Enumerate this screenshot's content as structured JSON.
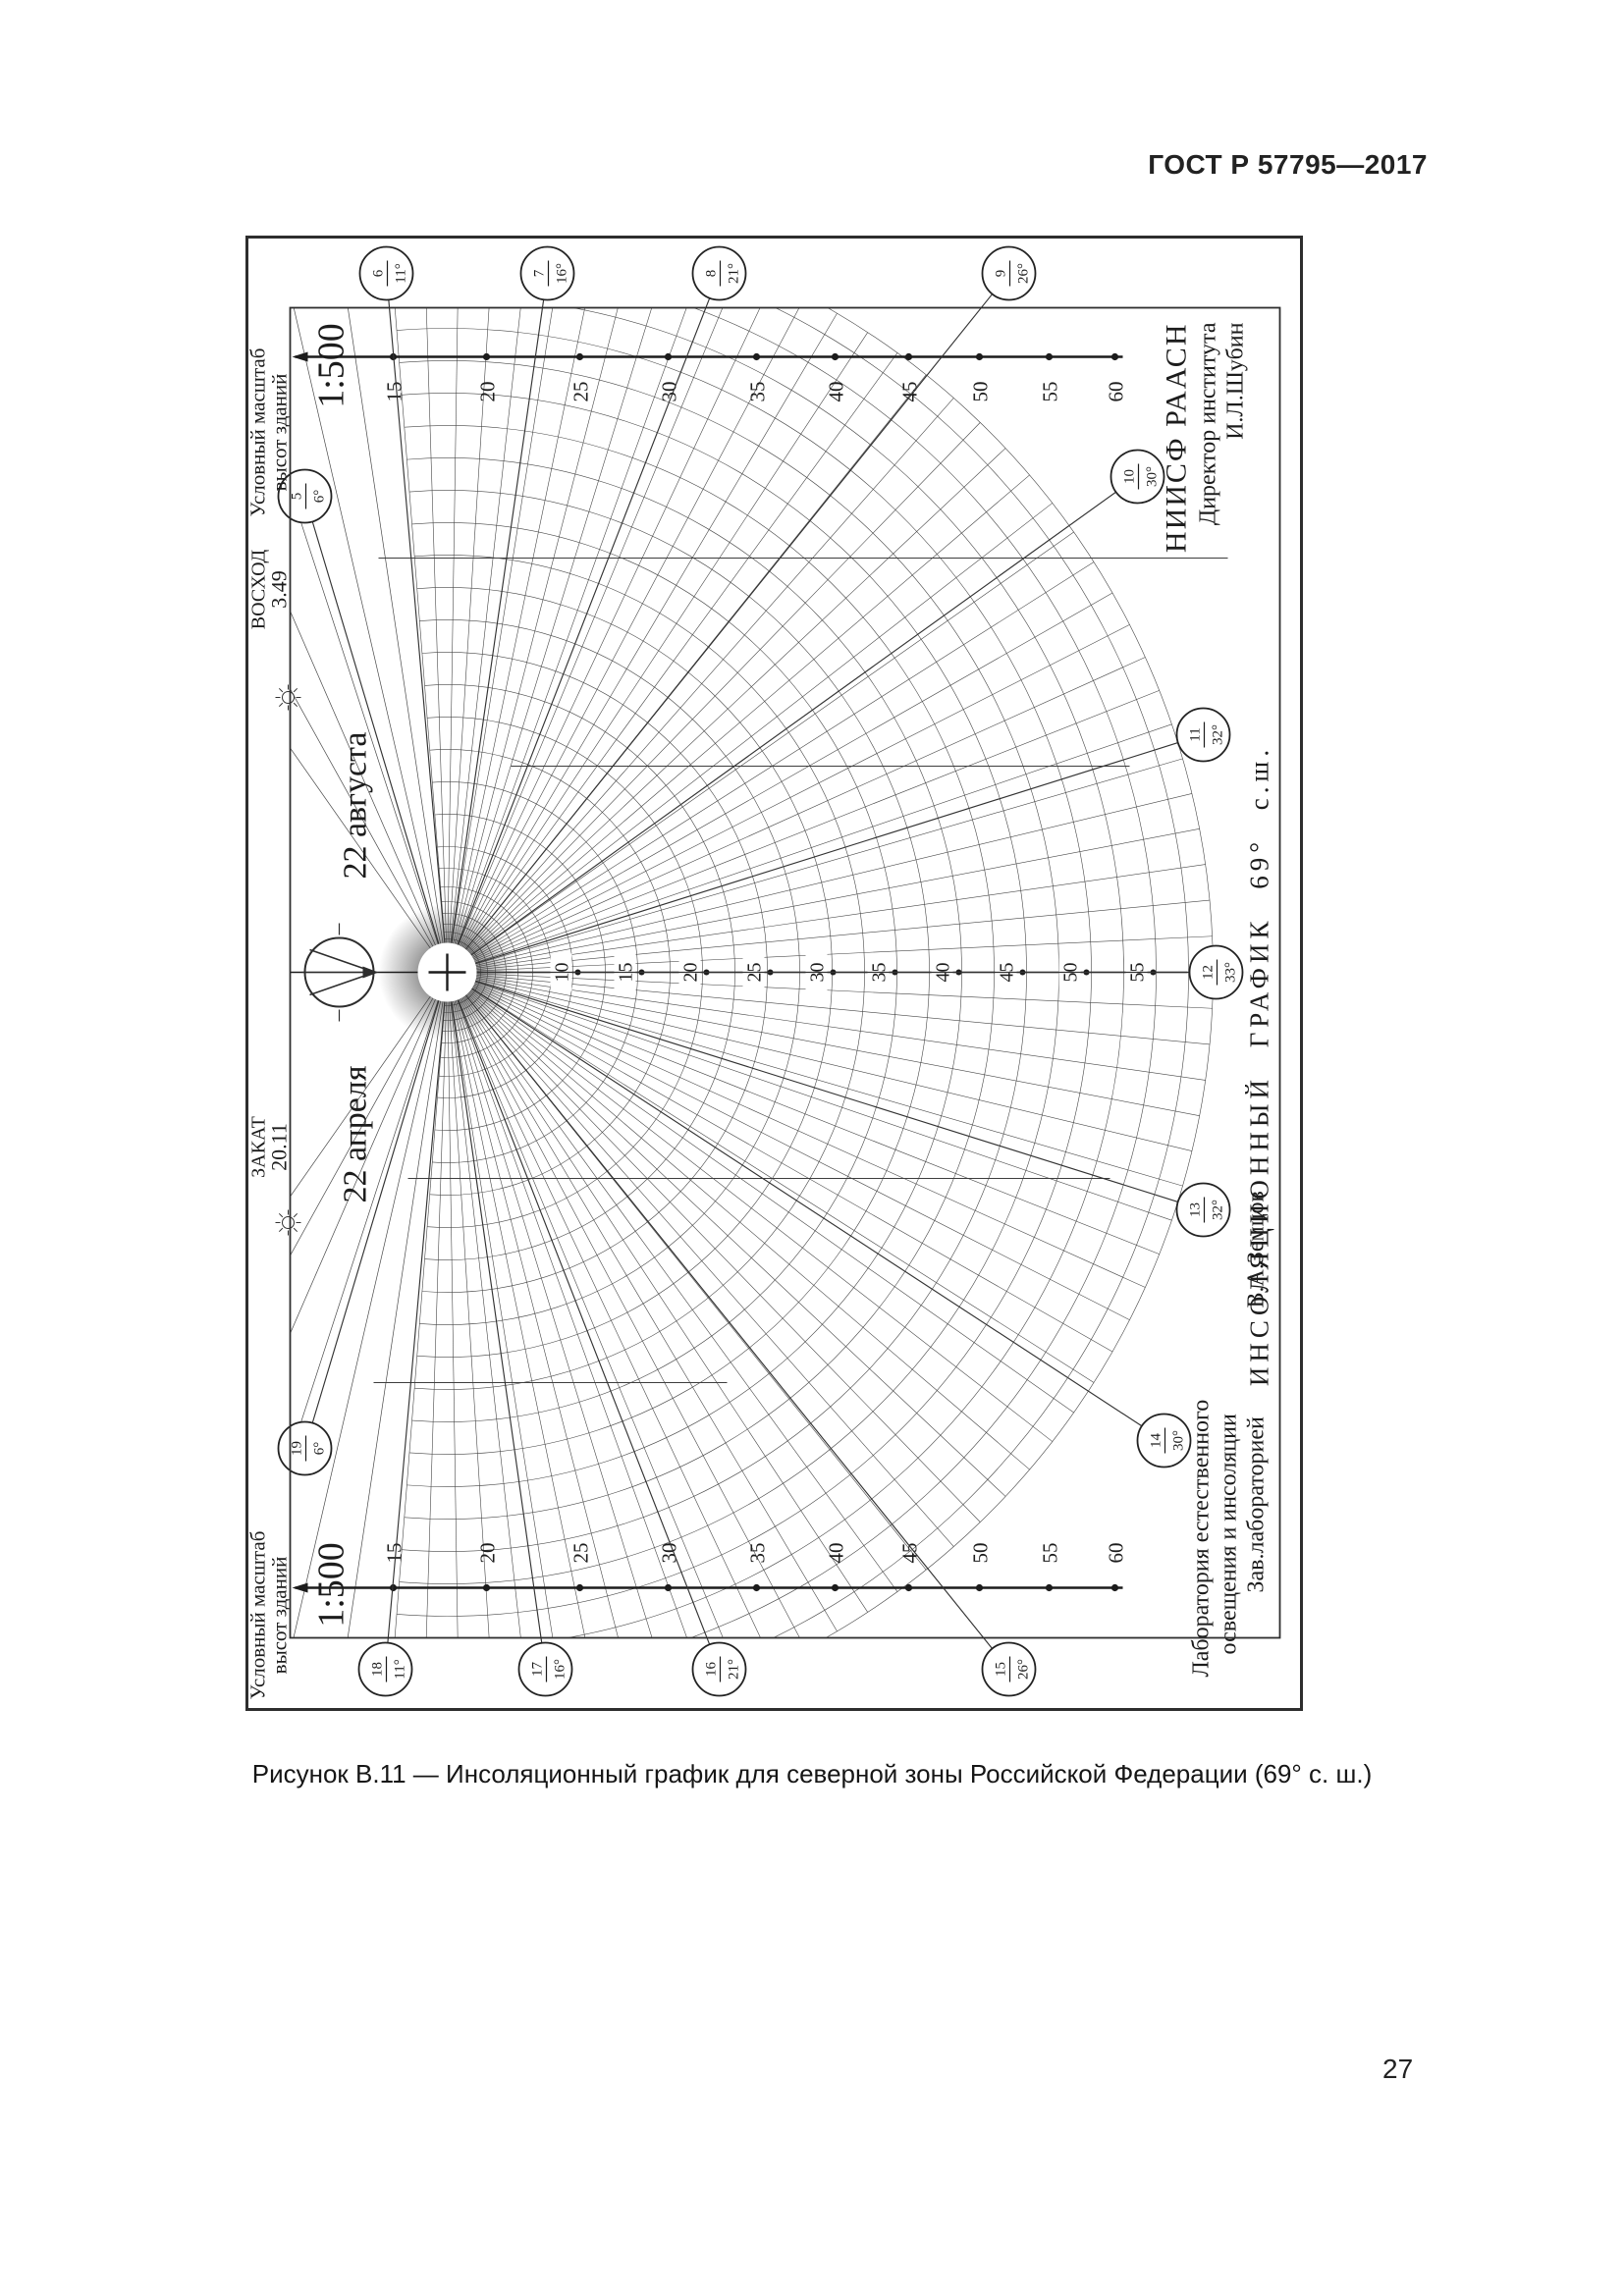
{
  "header": {
    "title": "ГОСТ Р 57795—2017"
  },
  "caption": "Рисунок В.11 — Инсоляционный график для северной зоны Российской Федерации (69° с. ш.)",
  "page_number": "27",
  "figure": {
    "title": "ИНСОЛЯЦИОННЫЙ ГРАФИК  69° с.ш.",
    "institute": {
      "line1": "НИИСФ РААСН",
      "line2": "Директор института",
      "line3": "И.Л.Шубин"
    },
    "laboratory": {
      "line1": "Лаборатория естественного",
      "line2": "освещения и инсоляции",
      "line3": "Зав.лабораторией",
      "line4": "В.А.Земцов"
    },
    "scale_label": {
      "line1": "Условный масштаб",
      "line2": "высот зданий",
      "ratio": "1:500"
    },
    "sunrise": {
      "label": "ВОСХОД",
      "time": "3.49",
      "date": "22 августа"
    },
    "sunset": {
      "label": "ЗАКАТ",
      "time": "20.11",
      "date": "22 апреля"
    },
    "hour_marks": [
      {
        "hour": "5",
        "alt": "6°"
      },
      {
        "hour": "6",
        "alt": "11°"
      },
      {
        "hour": "7",
        "alt": "16°"
      },
      {
        "hour": "8",
        "alt": "21°"
      },
      {
        "hour": "9",
        "alt": "26°"
      },
      {
        "hour": "10",
        "alt": "30°"
      },
      {
        "hour": "11",
        "alt": "32°"
      },
      {
        "hour": "12",
        "alt": "33°"
      },
      {
        "hour": "13",
        "alt": "32°"
      },
      {
        "hour": "14",
        "alt": "30°"
      },
      {
        "hour": "15",
        "alt": "26°"
      },
      {
        "hour": "16",
        "alt": "21°"
      },
      {
        "hour": "17",
        "alt": "16°"
      },
      {
        "hour": "18",
        "alt": "11°"
      },
      {
        "hour": "19",
        "alt": "6°"
      }
    ],
    "meridian_labels": [
      "10",
      "15",
      "20",
      "25",
      "30",
      "35",
      "40",
      "45",
      "50",
      "55"
    ],
    "ruler_labels": [
      "15",
      "20",
      "25",
      "30",
      "35",
      "40",
      "45",
      "50",
      "55",
      "60"
    ]
  },
  "chart_data": {
    "type": "line",
    "title": "ИНСОЛЯЦИОННЫЙ ГРАФИК 69° с.ш.",
    "description": "Инсоляционный график (солнечная карта) для северной зоны Российской Федерации, 69° северной широты, на даты 22 апреля и 22 августа",
    "latitude_deg": 69,
    "dates": [
      "22 апреля",
      "22 августа"
    ],
    "sunrise_time": "3.49",
    "sunset_time": "20.11",
    "scale": "1:500",
    "xlabel": "час суток",
    "ylabel": "высота солнца, градусы",
    "x": [
      5,
      6,
      7,
      8,
      9,
      10,
      11,
      12,
      13,
      14,
      15,
      16,
      17,
      18,
      19
    ],
    "series": [
      {
        "name": "высота солнца по часам",
        "values": [
          6,
          11,
          16,
          21,
          26,
          30,
          32,
          33,
          32,
          30,
          26,
          21,
          16,
          11,
          6
        ]
      }
    ],
    "altitude_circle_labels": [
      10,
      15,
      20,
      25,
      30,
      35,
      40,
      45,
      50,
      55
    ],
    "height_scale_marks": [
      15,
      20,
      25,
      30,
      35,
      40,
      45,
      50,
      55,
      60
    ],
    "legend_position": "none",
    "grid": true
  }
}
